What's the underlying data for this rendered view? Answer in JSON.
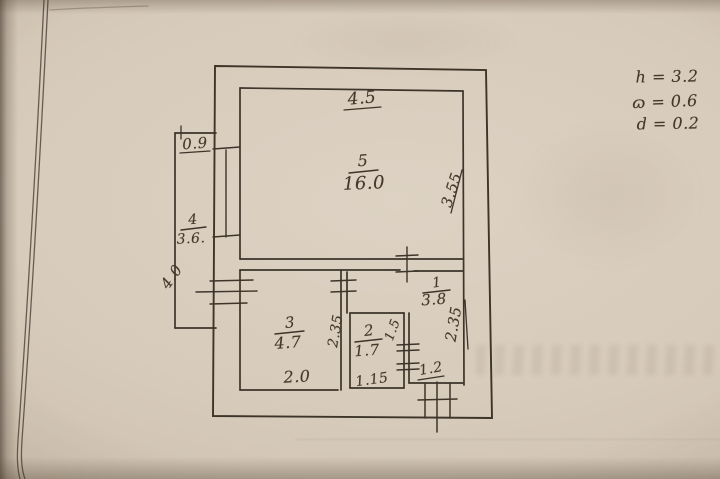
{
  "rooms": {
    "r1": {
      "number": "1",
      "area": "3.8"
    },
    "r2": {
      "number": "2",
      "area": "1.7"
    },
    "r3": {
      "number": "3",
      "area": "4.7"
    },
    "r4": {
      "number": "4",
      "area": "3.6."
    },
    "r5": {
      "number": "5",
      "area": "16.0"
    }
  },
  "dims": {
    "top_width": "4.5",
    "balcony_width": "0.9",
    "room5_depth": "3.55",
    "balcony_length": "4.0",
    "room3_depth": "2.35",
    "room2_depth": "1.5",
    "corridor_depth": "2.35",
    "room3_width": "2.0",
    "room2_width": "1.15",
    "entrance_width": "1.2"
  },
  "notes": {
    "height": "h = 3.2",
    "omega": "ɷ = 0.6",
    "d": "d = 0.2"
  },
  "colors": {
    "ink": "#3d342a",
    "paper": "#d6cabb"
  }
}
